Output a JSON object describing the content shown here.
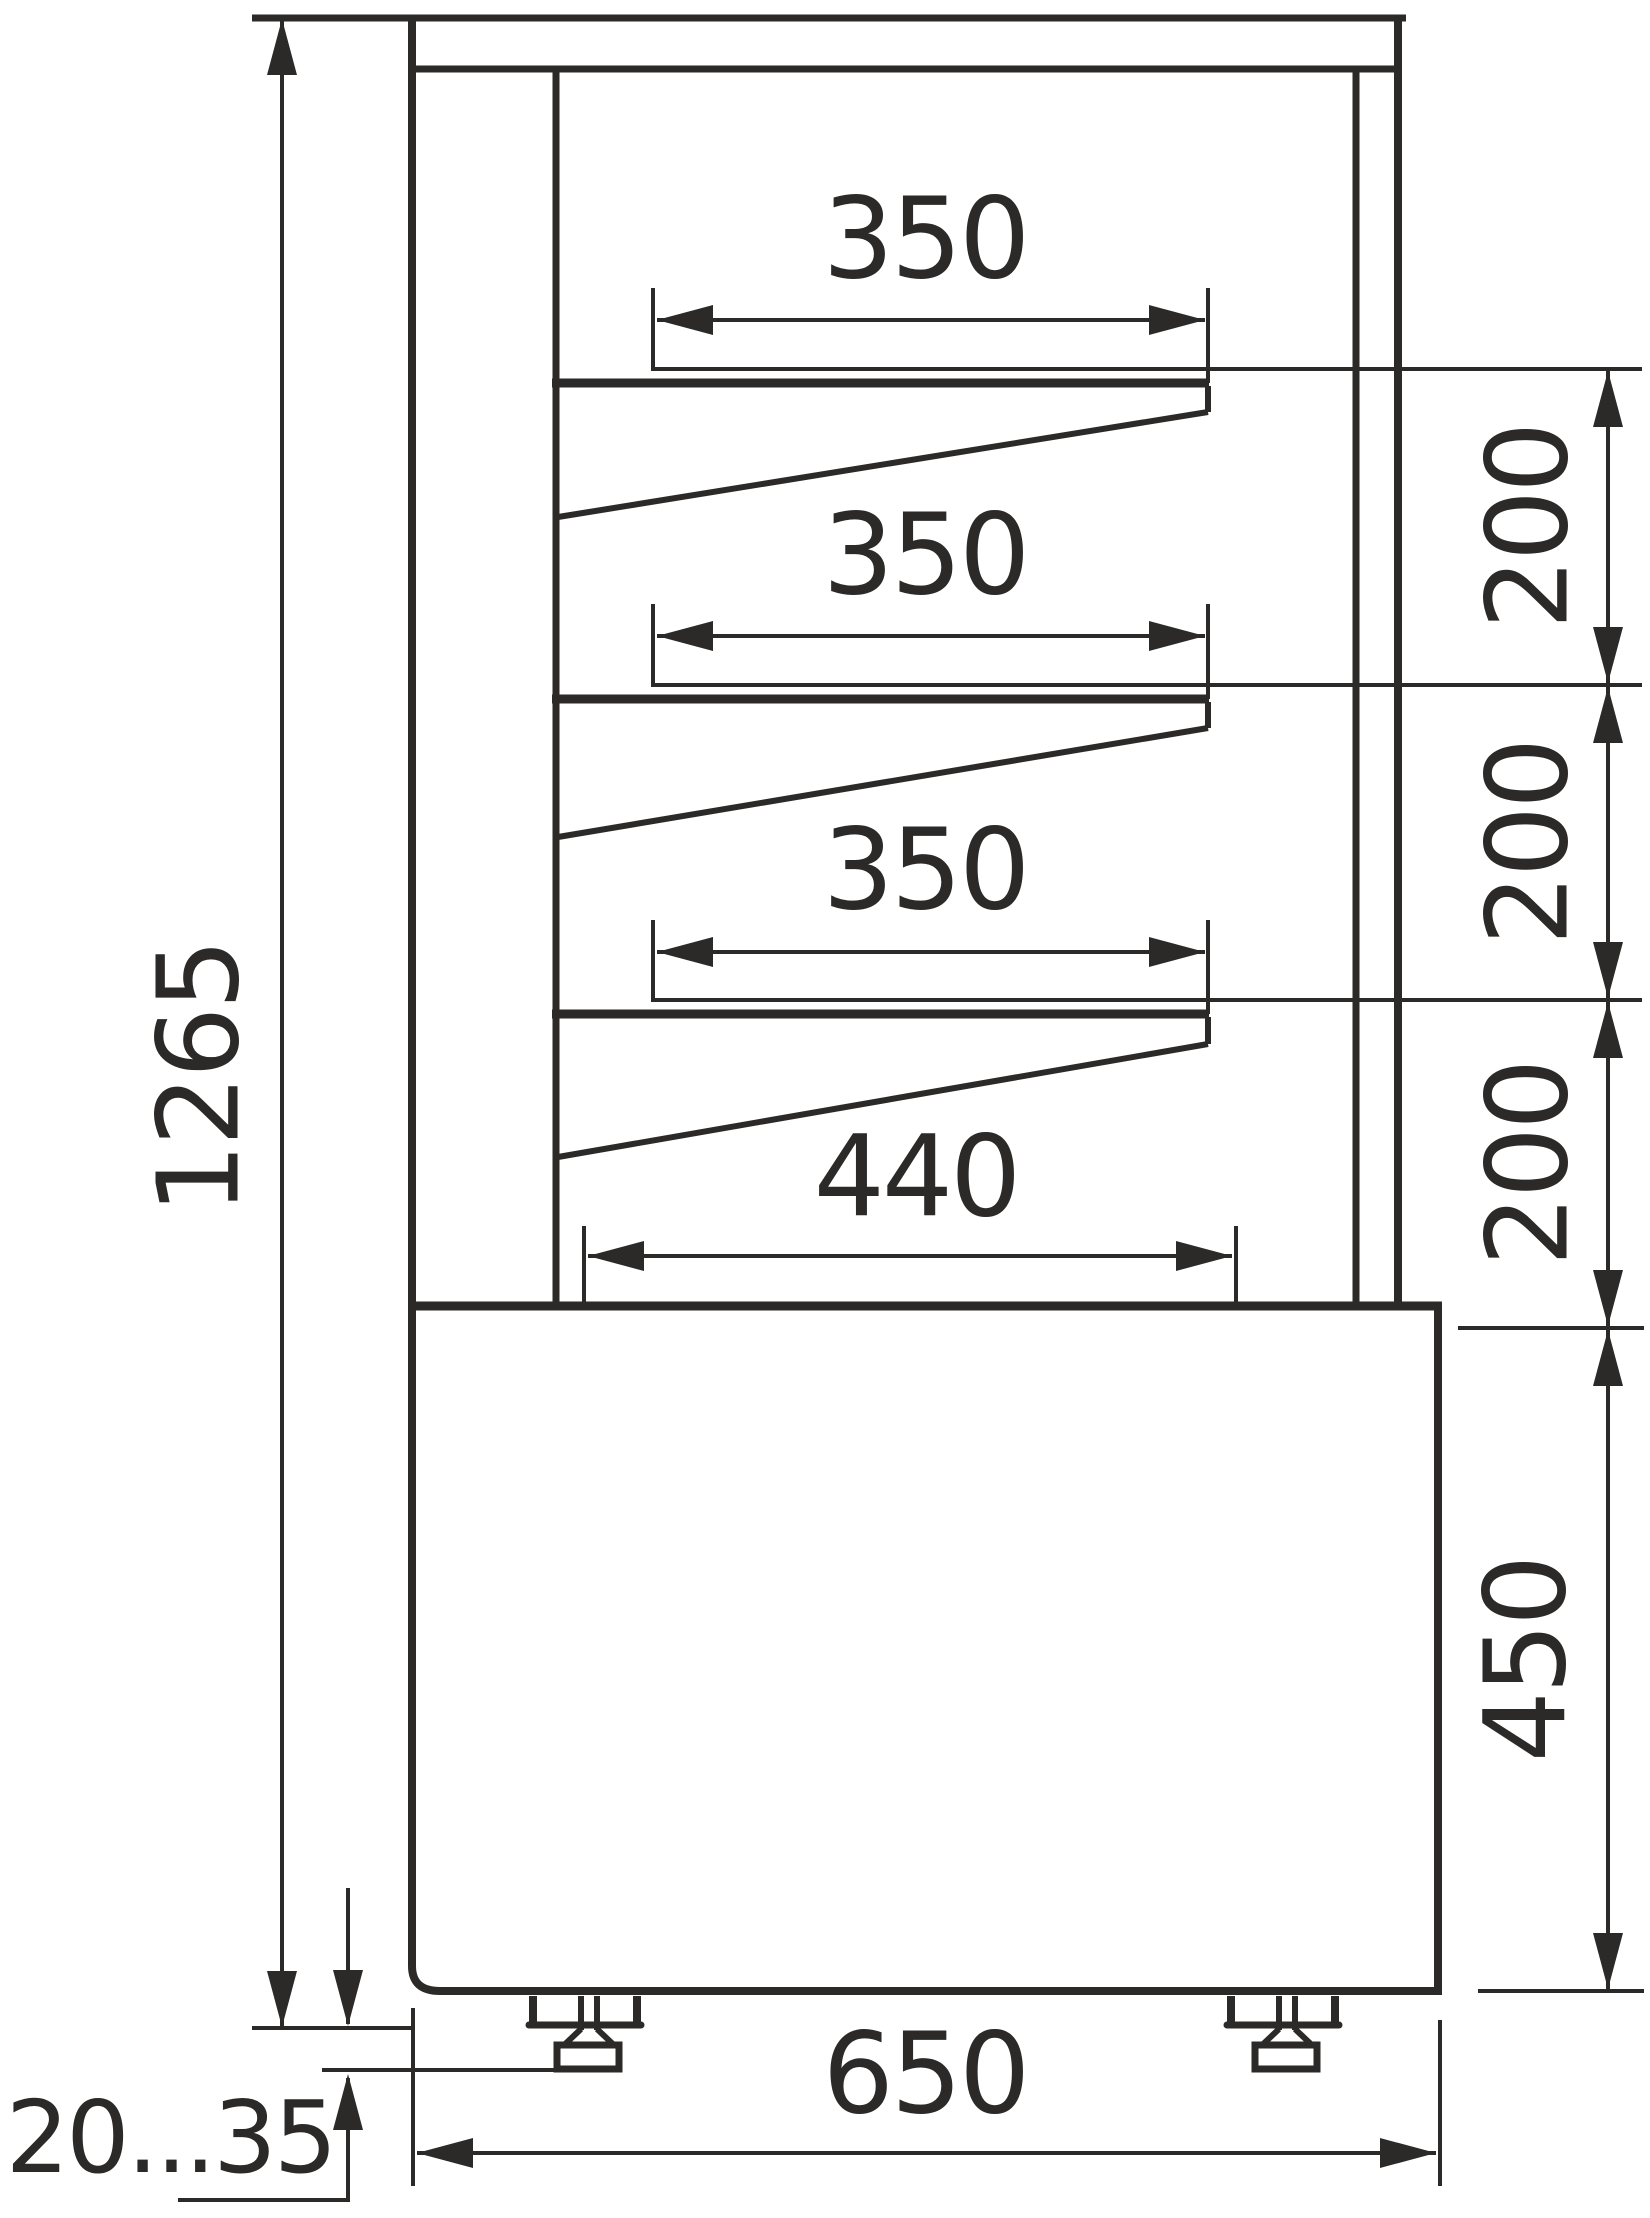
{
  "drawing": {
    "title": "Refrigerated display case - side section dimensional drawing",
    "units": "mm",
    "line_color": "#2b2a29",
    "background": "#ffffff",
    "labels": {
      "overall_height": "1265",
      "shelf_top_depth": "350",
      "shelf_middle_depth": "350",
      "shelf_bottom_depth": "350",
      "base_deck_depth": "440",
      "shelf_spacing_top": "200",
      "shelf_spacing_middle": "200",
      "shelf_spacing_bottom": "200",
      "base_height": "450",
      "overall_depth": "650",
      "leg_adjust_range": "20...35"
    },
    "dimensions": [
      {
        "name": "overall height",
        "value": "1265",
        "unit": "mm",
        "orientation": "vertical"
      },
      {
        "name": "top shelf depth",
        "value": "350",
        "unit": "mm",
        "orientation": "horizontal"
      },
      {
        "name": "middle shelf depth",
        "value": "350",
        "unit": "mm",
        "orientation": "horizontal"
      },
      {
        "name": "bottom shelf depth",
        "value": "350",
        "unit": "mm",
        "orientation": "horizontal"
      },
      {
        "name": "base deck depth",
        "value": "440",
        "unit": "mm",
        "orientation": "horizontal"
      },
      {
        "name": "shelf spacing 1",
        "value": "200",
        "unit": "mm",
        "orientation": "vertical"
      },
      {
        "name": "shelf spacing 2",
        "value": "200",
        "unit": "mm",
        "orientation": "vertical"
      },
      {
        "name": "shelf spacing 3",
        "value": "200",
        "unit": "mm",
        "orientation": "vertical"
      },
      {
        "name": "base unit height",
        "value": "450",
        "unit": "mm",
        "orientation": "vertical"
      },
      {
        "name": "overall depth",
        "value": "650",
        "unit": "mm",
        "orientation": "horizontal"
      },
      {
        "name": "adjustable leg range",
        "value": "20...35",
        "unit": "mm",
        "orientation": "vertical"
      }
    ]
  }
}
